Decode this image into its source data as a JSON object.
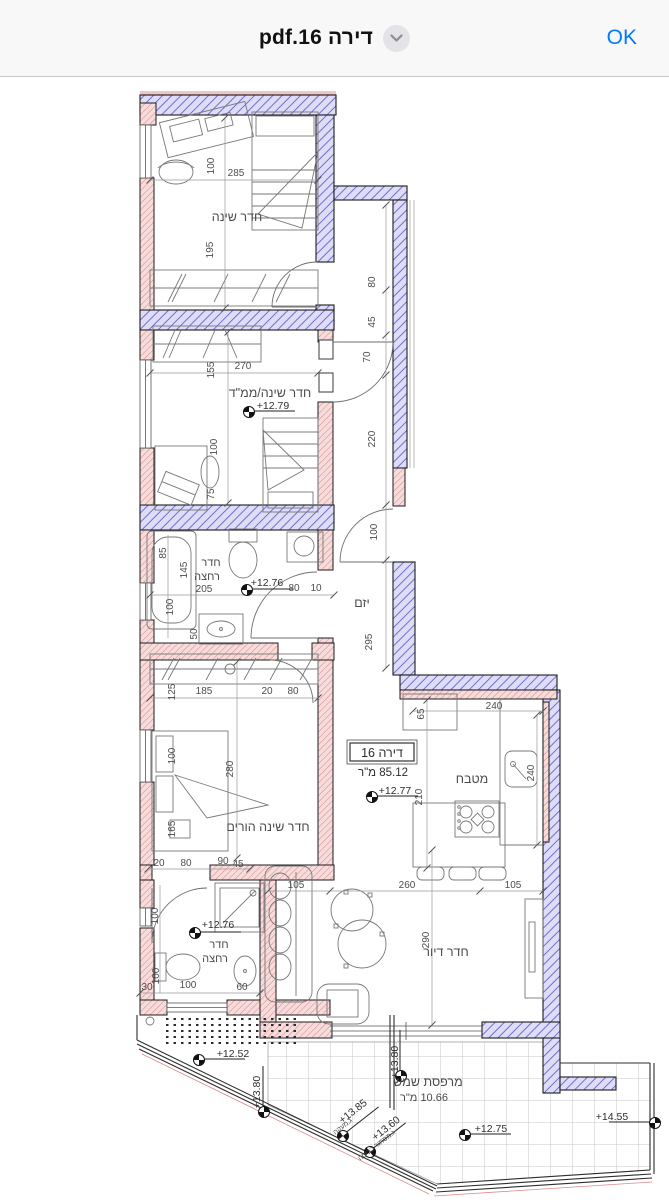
{
  "header": {
    "title": "pdf.16 דירה",
    "ok_label": "OK",
    "accent_color": "#007AFF",
    "bar_background": "#f8f8f8"
  },
  "plan": {
    "colors": {
      "exterior_wall_hatch": "#7070cf",
      "exterior_wall_fill": "#dedcf6",
      "interior_wall_hatch": "#d98b8b",
      "interior_wall_fill": "#f7dcdc",
      "line_color": "#1c1c1c"
    },
    "apartment_box": {
      "name": "דירה 16",
      "area": "85.12 מ\"ר",
      "elevation": "+12.77"
    },
    "labels": [
      {
        "t": "חדר שינה",
        "x": 237,
        "y": 221,
        "c": "room"
      },
      {
        "t": "חדר שינה/ממ\"ד",
        "x": 270,
        "y": 397,
        "c": "room"
      },
      {
        "t": "חדר",
        "x": 211,
        "y": 566,
        "c": "room2"
      },
      {
        "t": "רחצה",
        "x": 207,
        "y": 580,
        "c": "room2"
      },
      {
        "t": "יזם",
        "x": 362,
        "y": 607,
        "c": "room"
      },
      {
        "t": "מטבח",
        "x": 472,
        "y": 783,
        "c": "room"
      },
      {
        "t": "חדר שינה הורים",
        "x": 268,
        "y": 831,
        "c": "room"
      },
      {
        "t": "חדר",
        "x": 219,
        "y": 948,
        "c": "room2"
      },
      {
        "t": "רחצה",
        "x": 215,
        "y": 962,
        "c": "room2"
      },
      {
        "t": "חדר דיור",
        "x": 446,
        "y": 956,
        "c": "room"
      },
      {
        "t": "מרפסת שמש",
        "x": 428,
        "y": 1086,
        "c": "room"
      },
      {
        "t": "10.66 מ\"ר",
        "x": 424,
        "y": 1101,
        "c": "room2"
      },
      {
        "t": "דירה 16",
        "x": 382,
        "y": 757,
        "c": "apt"
      },
      {
        "t": "85.12 מ\"ר",
        "x": 383,
        "y": 776,
        "c": "apt2"
      },
      {
        "t": "+12.79",
        "x": 273,
        "y": 409,
        "c": "elev"
      },
      {
        "t": "+12.76",
        "x": 267,
        "y": 586,
        "c": "elev"
      },
      {
        "t": "+12.77",
        "x": 395,
        "y": 794,
        "c": "elev"
      },
      {
        "t": "+12.76",
        "x": 218,
        "y": 928,
        "c": "elev"
      },
      {
        "t": "+12.52",
        "x": 233,
        "y": 1057,
        "c": "elev"
      },
      {
        "t": "+12.75",
        "x": 491,
        "y": 1132,
        "c": "elev"
      },
      {
        "t": "+14.55",
        "x": 612,
        "y": 1120,
        "c": "elev"
      },
      {
        "t": "+13.85",
        "x": 355,
        "y": 1114,
        "c": "elev",
        "r": -38
      },
      {
        "t": "ג.מעקה",
        "x": 344,
        "y": 1128,
        "c": "note",
        "r": -38
      },
      {
        "t": "+13.60",
        "x": 388,
        "y": 1131,
        "c": "elev",
        "r": -38
      },
      {
        "t": "ג.מסתור כביסה",
        "x": 378,
        "y": 1147,
        "c": "note",
        "r": -38
      },
      {
        "t": "+13.80",
        "x": 398,
        "y": 1062,
        "c": "elev",
        "r": -90
      },
      {
        "t": "+13.80",
        "x": 260,
        "y": 1092,
        "c": "elev",
        "r": -90
      },
      {
        "t": "100",
        "x": 214,
        "y": 166,
        "c": "dim",
        "r": -90
      },
      {
        "t": "285",
        "x": 236,
        "y": 176,
        "c": "dim"
      },
      {
        "t": "195",
        "x": 213,
        "y": 250,
        "c": "dim",
        "r": -90
      },
      {
        "t": "155",
        "x": 214,
        "y": 370,
        "c": "dim",
        "r": -90
      },
      {
        "t": "270",
        "x": 243,
        "y": 369,
        "c": "dim"
      },
      {
        "t": "100",
        "x": 217,
        "y": 447,
        "c": "dim",
        "r": -90
      },
      {
        "t": "75",
        "x": 214,
        "y": 494,
        "c": "dim",
        "r": -90
      },
      {
        "t": "80",
        "x": 375,
        "y": 282,
        "c": "dim",
        "r": -90
      },
      {
        "t": "45",
        "x": 375,
        "y": 322,
        "c": "dim",
        "r": -90
      },
      {
        "t": "70",
        "x": 370,
        "y": 357,
        "c": "dim",
        "r": -90
      },
      {
        "t": "220",
        "x": 375,
        "y": 439,
        "c": "dim",
        "r": -90
      },
      {
        "t": "100",
        "x": 377,
        "y": 532,
        "c": "dim",
        "r": -90
      },
      {
        "t": "295",
        "x": 372,
        "y": 642,
        "c": "dim",
        "r": -90
      },
      {
        "t": "85",
        "x": 166,
        "y": 553,
        "c": "dim",
        "r": -90
      },
      {
        "t": "145",
        "x": 187,
        "y": 570,
        "c": "dim",
        "r": -90
      },
      {
        "t": "205",
        "x": 204,
        "y": 592,
        "c": "dim"
      },
      {
        "t": "100",
        "x": 173,
        "y": 607,
        "c": "dim",
        "r": -90
      },
      {
        "t": "50",
        "x": 197,
        "y": 634,
        "c": "dim",
        "r": -90
      },
      {
        "t": "80",
        "x": 294,
        "y": 591,
        "c": "dim"
      },
      {
        "t": "10",
        "x": 316,
        "y": 591,
        "c": "dim"
      },
      {
        "t": "125",
        "x": 175,
        "y": 692,
        "c": "dim",
        "r": -90
      },
      {
        "t": "185",
        "x": 204,
        "y": 694,
        "c": "dim"
      },
      {
        "t": "20",
        "x": 267,
        "y": 694,
        "c": "dim"
      },
      {
        "t": "80",
        "x": 293,
        "y": 694,
        "c": "dim"
      },
      {
        "t": "100",
        "x": 175,
        "y": 756,
        "c": "dim",
        "r": -90
      },
      {
        "t": "280",
        "x": 233,
        "y": 769,
        "c": "dim",
        "r": -90
      },
      {
        "t": "165",
        "x": 175,
        "y": 829,
        "c": "dim",
        "r": -90
      },
      {
        "t": "20",
        "x": 159,
        "y": 866,
        "c": "dim"
      },
      {
        "t": "80",
        "x": 186,
        "y": 866,
        "c": "dim"
      },
      {
        "t": "90",
        "x": 223,
        "y": 864,
        "c": "dim"
      },
      {
        "t": "45",
        "x": 238,
        "y": 867,
        "c": "dim"
      },
      {
        "t": "100",
        "x": 158,
        "y": 916,
        "c": "dim",
        "r": -90
      },
      {
        "t": "100",
        "x": 159,
        "y": 976,
        "c": "dim",
        "r": -90
      },
      {
        "t": "30",
        "x": 147,
        "y": 990,
        "c": "dim"
      },
      {
        "t": "100",
        "x": 188,
        "y": 988,
        "c": "dim"
      },
      {
        "t": "60",
        "x": 242,
        "y": 990,
        "c": "dim"
      },
      {
        "t": "105",
        "x": 296,
        "y": 888,
        "c": "dim"
      },
      {
        "t": "260",
        "x": 407,
        "y": 888,
        "c": "dim"
      },
      {
        "t": "105",
        "x": 513,
        "y": 888,
        "c": "dim"
      },
      {
        "t": "290",
        "x": 429,
        "y": 940,
        "c": "dim",
        "r": -90
      },
      {
        "t": "65",
        "x": 424,
        "y": 714,
        "c": "dim",
        "r": -90
      },
      {
        "t": "240",
        "x": 494,
        "y": 709,
        "c": "dim"
      },
      {
        "t": "240",
        "x": 534,
        "y": 773,
        "c": "dim",
        "r": -90
      },
      {
        "t": "210",
        "x": 422,
        "y": 797,
        "c": "dim",
        "r": -90
      }
    ],
    "benchmarks": [
      {
        "x": 249,
        "y": 412
      },
      {
        "x": 247,
        "y": 590
      },
      {
        "x": 372,
        "y": 797
      },
      {
        "x": 195,
        "y": 933
      },
      {
        "x": 199,
        "y": 1060
      },
      {
        "x": 465,
        "y": 1135
      },
      {
        "x": 655,
        "y": 1123,
        "flip": true
      },
      {
        "x": 343,
        "y": 1136,
        "r": -38
      },
      {
        "x": 370,
        "y": 1152,
        "r": -38
      },
      {
        "x": 401,
        "y": 1076,
        "r": -90
      },
      {
        "x": 264,
        "y": 1112,
        "r": -90
      }
    ]
  }
}
